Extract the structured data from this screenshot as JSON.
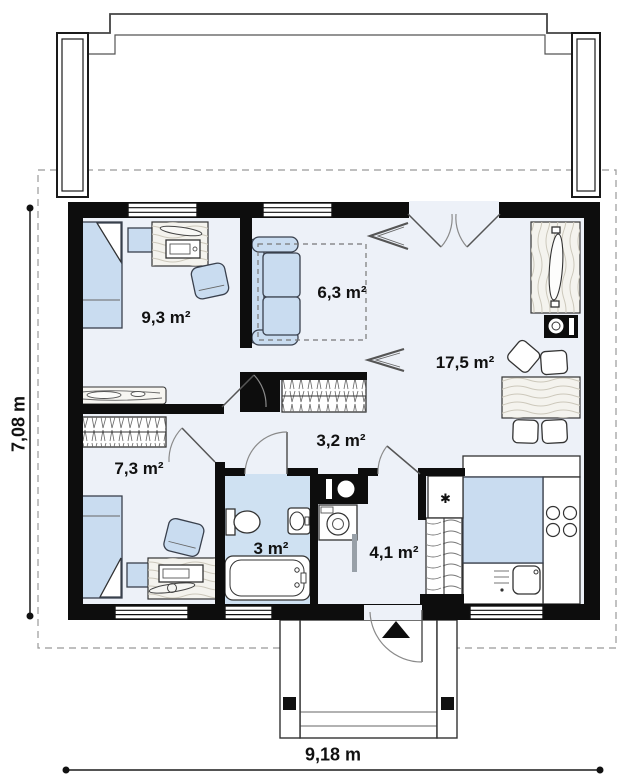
{
  "floor_plan": {
    "type": "single-storey house plan, top-down architectural drawing",
    "rooms": [
      {
        "name": "bedroom-top-left",
        "area": "9,3 m²"
      },
      {
        "name": "lounge-alcove",
        "area": "6,3 m²"
      },
      {
        "name": "living-room",
        "area": "17,5 m²"
      },
      {
        "name": "bedroom-bottom-left",
        "area": "7,3 m²"
      },
      {
        "name": "hallway",
        "area": "3,2 m²"
      },
      {
        "name": "bathroom",
        "area": "3 m²"
      },
      {
        "name": "vestibule",
        "area": "4,1 m²"
      }
    ],
    "dimensions": {
      "total_width": "9,18 m",
      "total_depth": "7,08 m"
    },
    "symbols": {
      "boiler": "✱"
    },
    "colors": {
      "wall": "#0d0d0d",
      "furniture_blue": "#c9dcf0",
      "bathroom_floor": "#cfe1f2",
      "floor": "#edf1f8",
      "wood": "#f4f3ee",
      "dashed_outline": "#999999"
    }
  }
}
